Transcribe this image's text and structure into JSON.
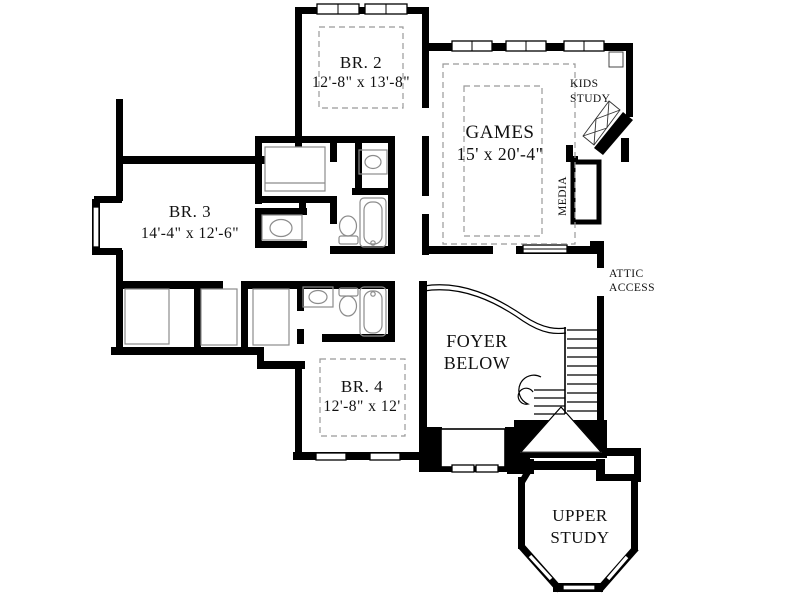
{
  "title": "Second Floor Plan",
  "rooms": {
    "br2": {
      "name": "BR. 2",
      "dims": "12'-8\" x 13'-8\""
    },
    "games": {
      "name": "GAMES",
      "dims": "15' x 20'-4\""
    },
    "kids_study": {
      "line1": "KIDS",
      "line2": "STUDY"
    },
    "media": {
      "label": "MEDIA"
    },
    "br3": {
      "name": "BR. 3",
      "dims": "14'-4\" x 12'-6\""
    },
    "attic_access": {
      "line1": "ATTIC",
      "line2": "ACCESS"
    },
    "foyer": {
      "line1": "FOYER",
      "line2": "BELOW"
    },
    "br4": {
      "name": "BR. 4",
      "dims": "12'-8\" x 12'"
    },
    "upper_study": {
      "line1": "UPPER",
      "line2": "STUDY"
    }
  },
  "colors": {
    "wall": "#000000",
    "background": "#ffffff",
    "fixture_line": "#8c8c8c",
    "rug_dash": "#999999"
  }
}
